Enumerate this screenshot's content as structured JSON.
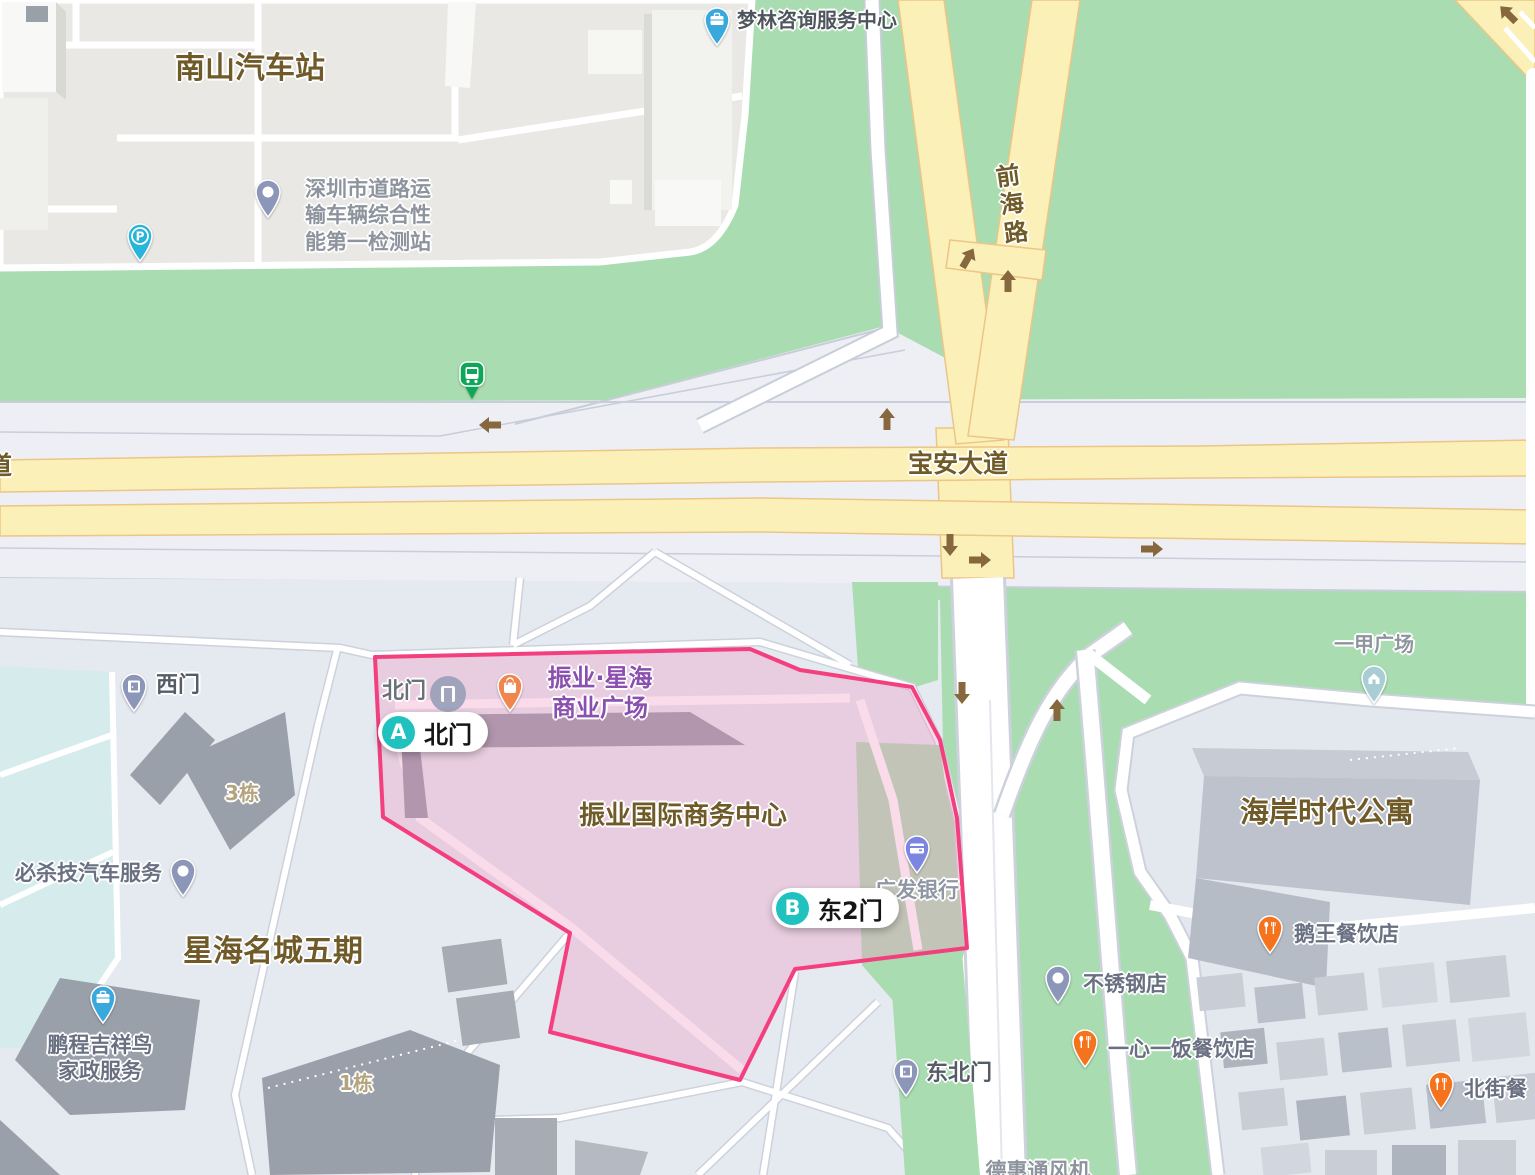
{
  "colors": {
    "greenery": "#A9DCB1",
    "road_yellow": "#FBF0B8",
    "road_yellow_casing": "#ECC587",
    "highlight_fill": "#ED9AC4",
    "highlight_border": "#F43F7F",
    "route_marker_teal": "#1FC2BE",
    "poi_orange": "#F0854E",
    "poi_food_orange": "#F4731C",
    "poi_blue": "#39A8DC",
    "poi_slate_pin": "#8C96B8",
    "bank_pin_purple": "#7C86E2",
    "bus_pin_green": "#0EA75A",
    "parking_pin_teal": "#28B5DC",
    "label_brown": "#6F5A28",
    "label_purple": "#8B4FB0"
  },
  "road_labels": {
    "baoan": "宝安大道",
    "baoan_partial": "道",
    "qianhai_chars": [
      "前",
      "海",
      "路"
    ]
  },
  "area_labels": {
    "nanshan_bus_station": "南山汽车站",
    "xinghai_mingcheng_phase5": "星海名城五期",
    "zhenye_intl_business_center": "振业国际商务中心",
    "haian_times_apartment": "海岸时代公寓",
    "building_3": "3栋",
    "building_1": "1栋",
    "dehui_partial": "德惠通风机"
  },
  "pois": {
    "menglin": {
      "name": "梦林咨询服务中心"
    },
    "inspection_station": {
      "lines": [
        "深圳市道路运",
        "输车辆综合性",
        "能第一检测站"
      ]
    },
    "zhenye_xinghai_plaza": {
      "lines": [
        "振业·星海",
        "商业广场"
      ]
    },
    "north_gate_small": {
      "name": "北门"
    },
    "west_gate": {
      "name": "西门"
    },
    "northeast_gate": {
      "name": "东北门"
    },
    "guangfa_bank": {
      "name": "广发银行"
    },
    "bishaji_auto": {
      "name": "必杀技汽车服务"
    },
    "pengcheng": {
      "lines": [
        "鹏程吉祥鸟",
        "家政服务"
      ]
    },
    "stainless_steel": {
      "name": "不锈钢店"
    },
    "yixinyifan": {
      "name": "一心一饭餐饮店"
    },
    "ewang": {
      "name": "鹅王餐饮店"
    },
    "beijie": {
      "name": "北街餐"
    },
    "yijia_plaza": {
      "name": "一甲广场"
    }
  },
  "route_markers": {
    "a": {
      "letter": "A",
      "label": "北门"
    },
    "b": {
      "letter": "B",
      "label": "东2门"
    }
  }
}
